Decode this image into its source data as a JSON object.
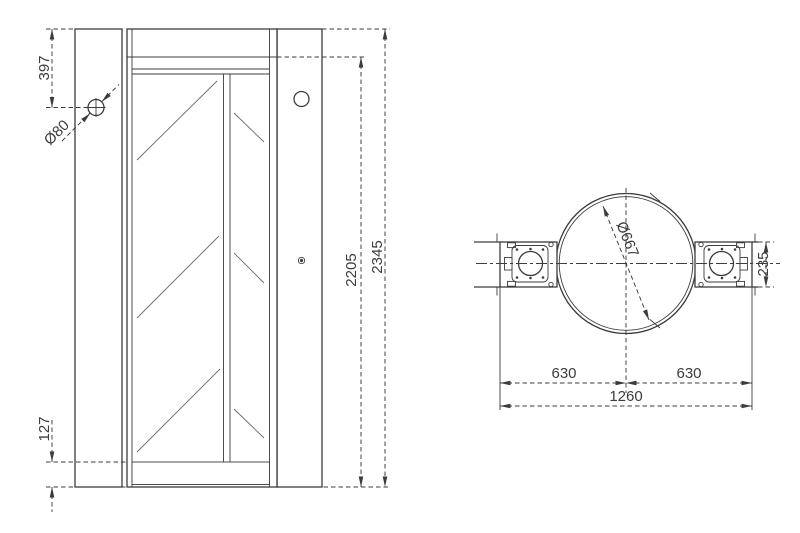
{
  "front_view": {
    "labels": {
      "offset_top": "397",
      "hole_dia": "Ø80",
      "door_height": "2205",
      "total_height": "2345",
      "offset_bottom": "127"
    }
  },
  "plan_view": {
    "labels": {
      "drum_dia": "Ø667",
      "post_depth": "235",
      "half_left": "630",
      "half_right": "630",
      "total_width": "1260"
    }
  },
  "colors": {
    "line": "#3c3c3c",
    "hatch": "#6b6b6b",
    "background": "#ffffff"
  }
}
